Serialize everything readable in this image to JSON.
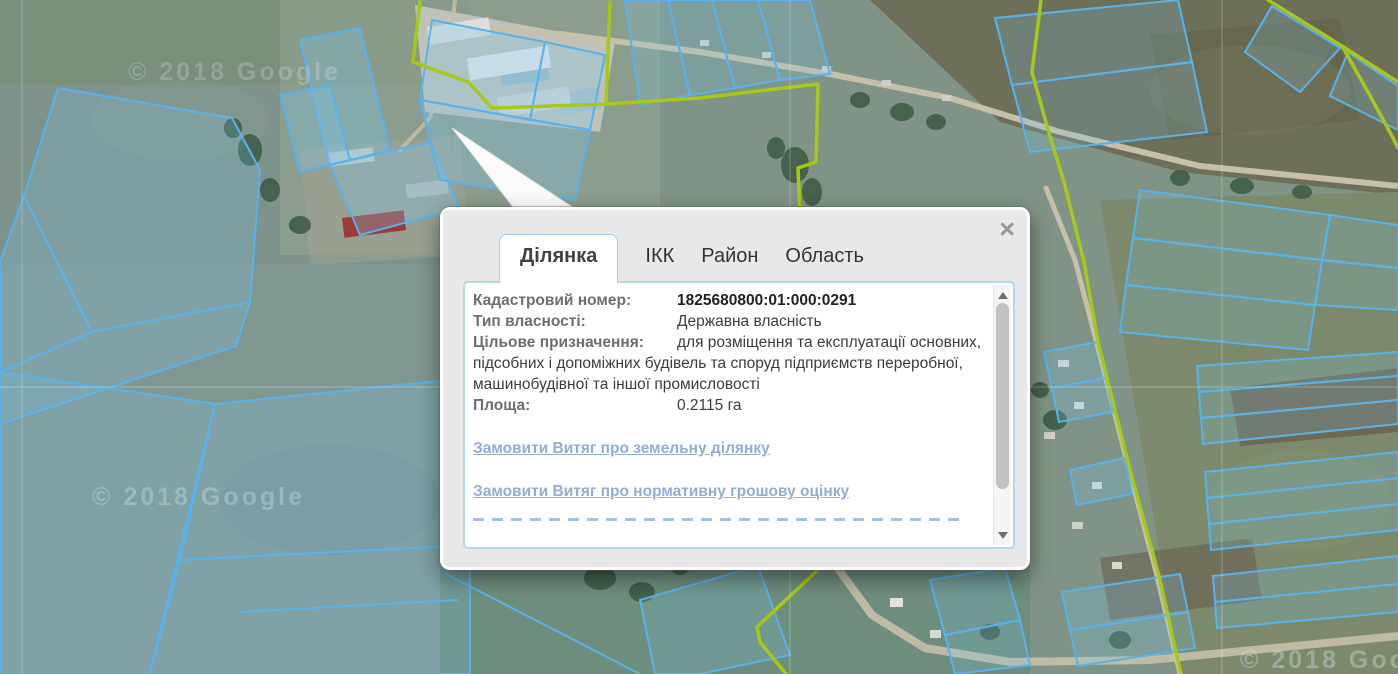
{
  "map": {
    "watermark_topleft": "© 2018 Google",
    "watermark_bottomleft": "© 2018 Google",
    "watermark_bottomright": "© 2018 Google",
    "parcel_outline_color": "#58b2ec",
    "boundary_line_color": "#a7c816",
    "link_color": "#93acd7"
  },
  "popup": {
    "close_label": "×",
    "tabs": [
      {
        "label": "Ділянка",
        "active": true
      },
      {
        "label": "ІКК",
        "active": false
      },
      {
        "label": "Район",
        "active": false
      },
      {
        "label": "Область",
        "active": false
      }
    ],
    "fields": [
      {
        "label": "Кадастровий номер:",
        "value": "1825680800:01:000:0291"
      },
      {
        "label": "Тип власності:",
        "value": "Державна власність"
      },
      {
        "label": "Цільове призначення:",
        "value": "для розміщення та експлуатації основних, підсобних і допоміжних будівель та споруд підприємств переробної, машинобудівної та іншої промисловості"
      },
      {
        "label": "Площа:",
        "value": "0.2115 га"
      }
    ],
    "links": [
      "Замовити Витяг про земельну ділянку",
      "Замовити Витяг про нормативну грошову оцінку"
    ]
  }
}
